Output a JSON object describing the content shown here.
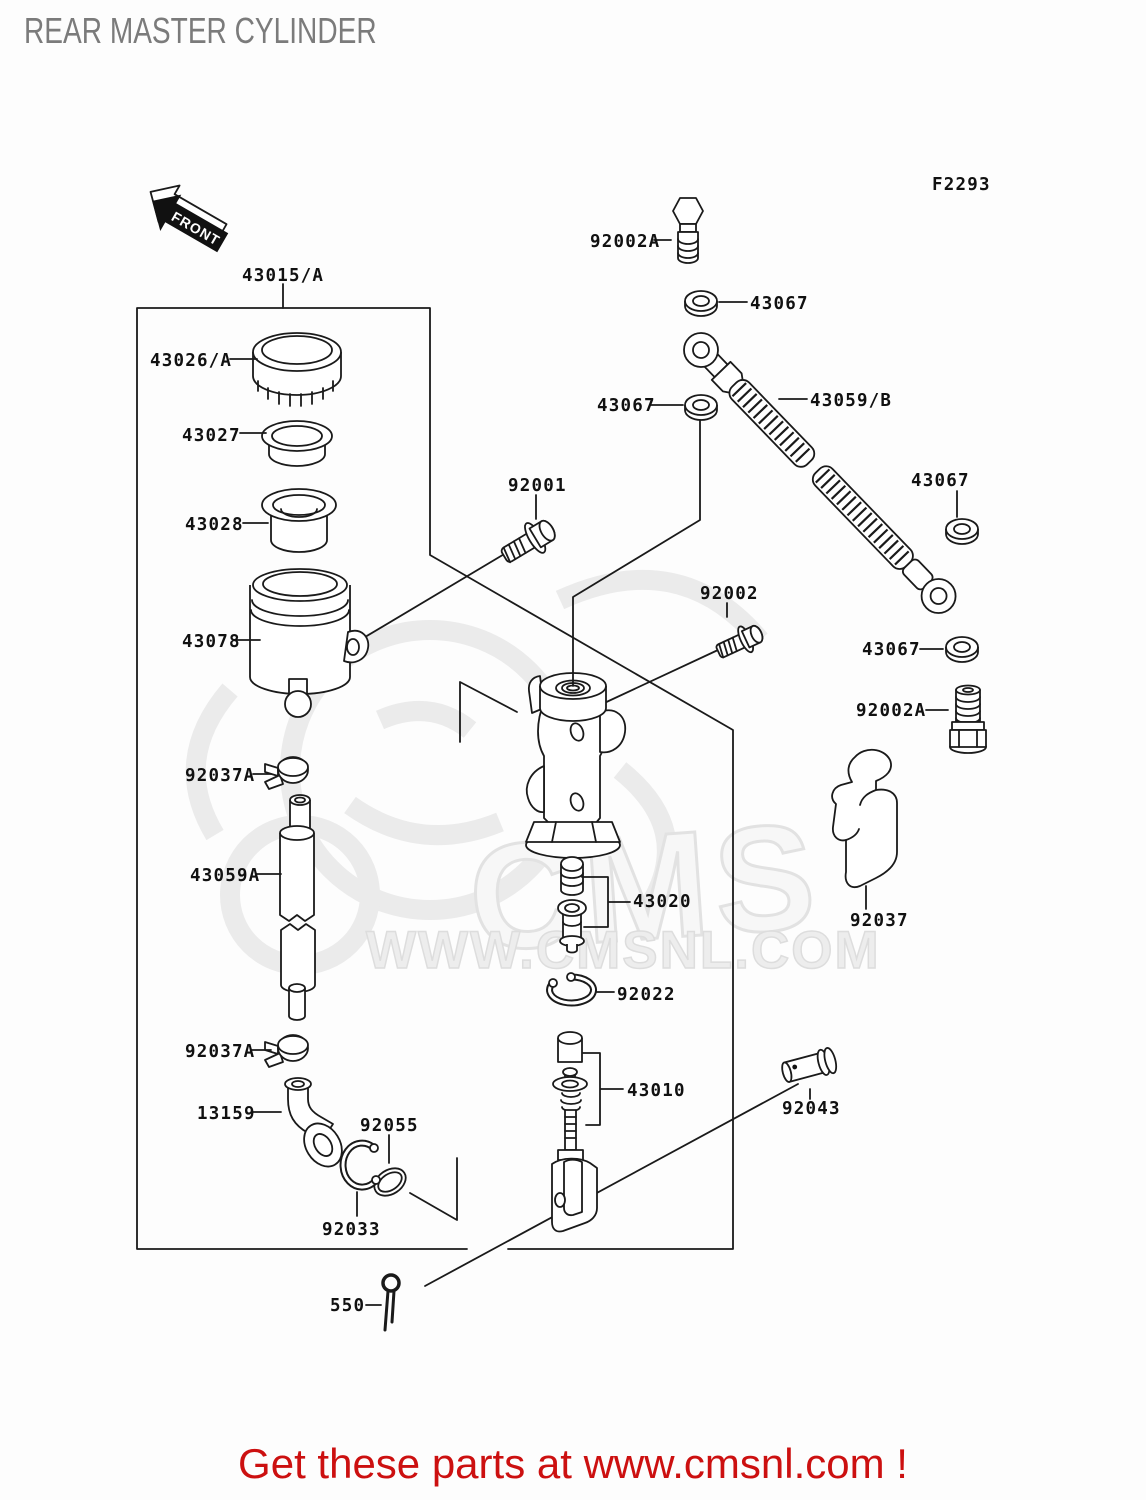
{
  "page": {
    "title": "REAR MASTER CYLINDER",
    "figure_code": "F2293",
    "front_arrow_label": "FRONT",
    "footer": "Get these parts at www.cmsnl.com !",
    "watermark_cms": "CMS",
    "watermark_url": "WWW.CMSNL.COM"
  },
  "colors": {
    "line": "#1a1a1a",
    "title_gray": "#7b7b7b",
    "footer_red": "#cc1010",
    "watermark_gray": "#e9e9e9"
  },
  "labels": [
    {
      "id": "43015a",
      "text": "43015/A",
      "x": 242,
      "y": 281
    },
    {
      "id": "43026a",
      "text": "43026/A",
      "x": 150,
      "y": 366
    },
    {
      "id": "43027",
      "text": "43027",
      "x": 182,
      "y": 441
    },
    {
      "id": "43028",
      "text": "43028",
      "x": 185,
      "y": 530
    },
    {
      "id": "43078",
      "text": "43078",
      "x": 182,
      "y": 647
    },
    {
      "id": "92001",
      "text": "92001",
      "x": 508,
      "y": 491
    },
    {
      "id": "92002",
      "text": "92002",
      "x": 700,
      "y": 599
    },
    {
      "id": "92002a-top",
      "text": "92002A",
      "x": 590,
      "y": 247
    },
    {
      "id": "43067-top",
      "text": "43067",
      "x": 750,
      "y": 309
    },
    {
      "id": "43067-mid",
      "text": "43067",
      "x": 597,
      "y": 411
    },
    {
      "id": "43059b",
      "text": "43059/B",
      "x": 810,
      "y": 406
    },
    {
      "id": "43067-right-upper",
      "text": "43067",
      "x": 911,
      "y": 486
    },
    {
      "id": "43067-right-lower",
      "text": "43067",
      "x": 862,
      "y": 655
    },
    {
      "id": "92002a-right",
      "text": "92002A",
      "x": 856,
      "y": 716
    },
    {
      "id": "92037",
      "text": "92037",
      "x": 850,
      "y": 926
    },
    {
      "id": "92037a-upper",
      "text": "92037A",
      "x": 185,
      "y": 781
    },
    {
      "id": "43059a",
      "text": "43059A",
      "x": 190,
      "y": 881
    },
    {
      "id": "43020",
      "text": "43020",
      "x": 633,
      "y": 907
    },
    {
      "id": "92022",
      "text": "92022",
      "x": 617,
      "y": 1000
    },
    {
      "id": "92037a-lower",
      "text": "92037A",
      "x": 185,
      "y": 1057
    },
    {
      "id": "13159",
      "text": "13159",
      "x": 197,
      "y": 1119
    },
    {
      "id": "92055",
      "text": "92055",
      "x": 360,
      "y": 1131
    },
    {
      "id": "43010",
      "text": "43010",
      "x": 627,
      "y": 1096
    },
    {
      "id": "92043",
      "text": "92043",
      "x": 782,
      "y": 1114
    },
    {
      "id": "92033",
      "text": "92033",
      "x": 322,
      "y": 1235
    },
    {
      "id": "550",
      "text": "550",
      "x": 330,
      "y": 1311
    }
  ]
}
